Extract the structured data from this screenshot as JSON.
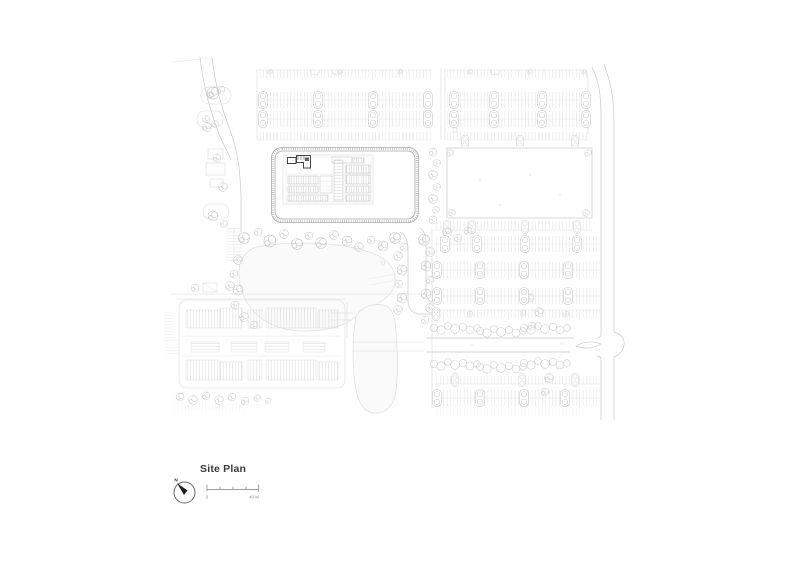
{
  "title_block": {
    "title": "Site Plan",
    "north_label": "N",
    "scale_bar": {
      "zero_label": "0",
      "max_label": "40 M"
    }
  },
  "colors": {
    "c-bg": "#ffffff",
    "c-faint": "#dcdcdc",
    "c-light": "#c9c9c9",
    "c-med": "#a9a9a9",
    "c-dark": "#454545",
    "c-text": "#3a3a3a",
    "c-muted": "#8f8f8f",
    "c-water": "#fafafa"
  }
}
